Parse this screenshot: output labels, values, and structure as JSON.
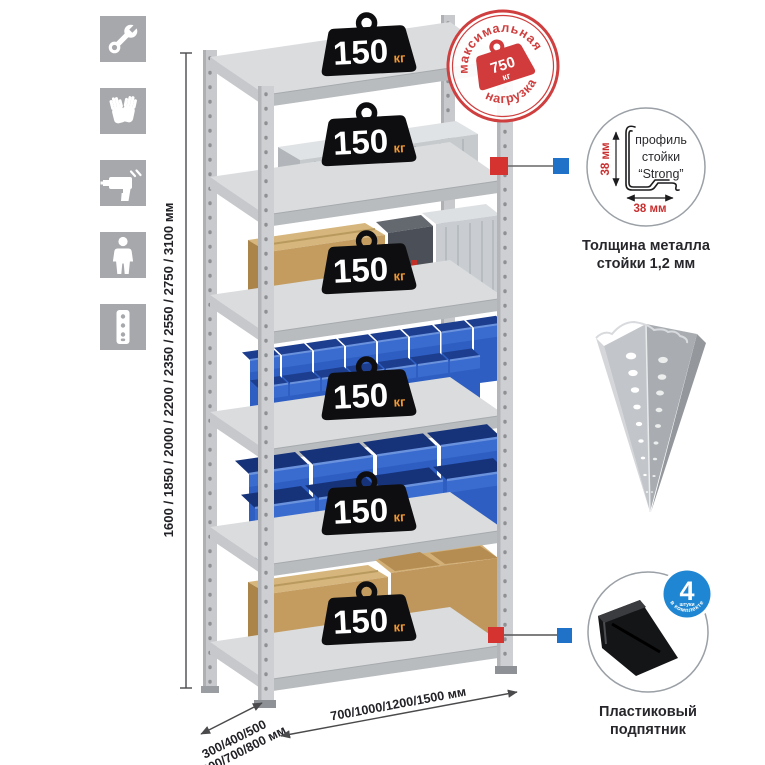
{
  "icons": [
    {
      "name": "wrench"
    },
    {
      "name": "gloves"
    },
    {
      "name": "drill"
    },
    {
      "name": "person"
    },
    {
      "name": "rack-post"
    }
  ],
  "dimensions": {
    "height_label": "1600 / 1850 / 2000 / 2200 / 2350 / 2550 / 2750 / 3100 мм",
    "depth_line1": "300/400/500",
    "depth_line2": "600/700/800 мм",
    "width_label": "700/1000/1200/1500 мм"
  },
  "shelf_badges": [
    {
      "value": "150",
      "unit": "кг"
    },
    {
      "value": "150",
      "unit": "кг"
    },
    {
      "value": "150",
      "unit": "кг"
    },
    {
      "value": "150",
      "unit": "кг"
    },
    {
      "value": "150",
      "unit": "кг"
    },
    {
      "value": "150",
      "unit": "кг"
    }
  ],
  "stamp": {
    "arc_top": "максимальная",
    "arc_bottom": "нагрузка",
    "weight_value": "750",
    "weight_unit": "кг"
  },
  "profile_callout": {
    "dim_vertical": "38 мм",
    "dim_horizontal": "38 мм",
    "line1": "профиль",
    "line2": "стойки",
    "line3": "“Strong”",
    "caption1": "Толщина металла",
    "caption2": "стойки 1,2 мм"
  },
  "foot_callout": {
    "badge_value": "4",
    "badge_sub": "штуки",
    "badge_arc": "в комплекте",
    "caption1": "Пластиковый",
    "caption2": "подпятник"
  },
  "colors": {
    "stamp_red": "#cf3f3f",
    "connector_red": "#d5332f",
    "connector_blue": "#1f72c8",
    "bin_blue": "#2e5ec2",
    "badge_black": "#0e0e10",
    "badge_unit_orange": "#f09a36",
    "icon_bg": "#a7a8ac",
    "metal_gray": "#dadcde",
    "foot_badge_blue": "#1e86d2",
    "dim_red": "#c92f2f"
  }
}
